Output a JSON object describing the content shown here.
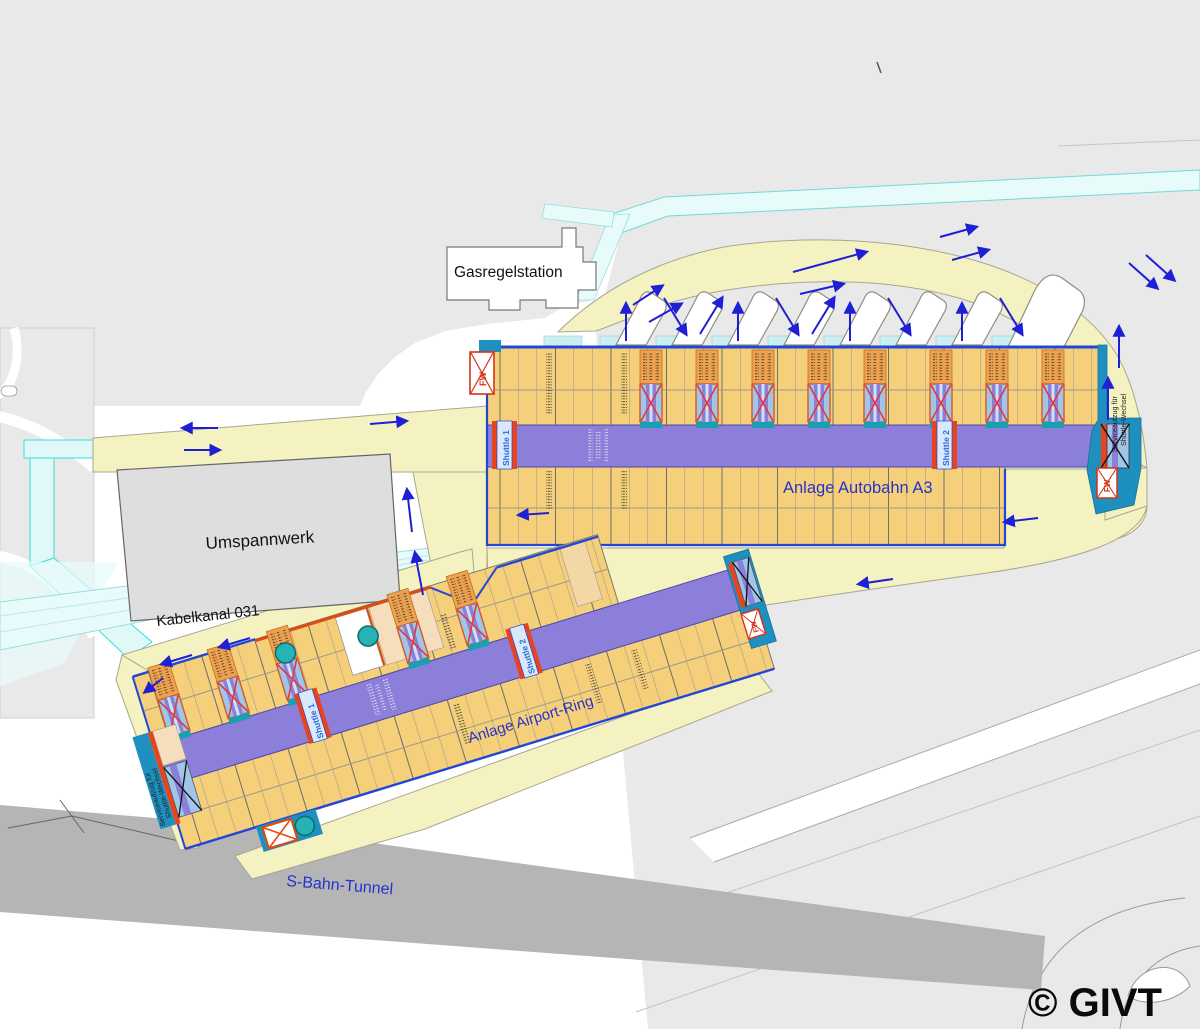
{
  "map": {
    "background_labels": {
      "gasregelstation": "Gasregelstation",
      "umspannwerk": "Umspannwerk",
      "kabelkanal": "Kabelkanal 031",
      "sbahn_tunnel": "S-Bahn-Tunnel"
    },
    "facilities": {
      "autobahn_a3": {
        "label": "Anlage Autobahn A3",
        "shuttle_1": "Shuttle 1",
        "shuttle_2": "Shuttle 2",
        "service_lift_line1": "Serviceaufzug für",
        "service_lift_line2": "Shuttle-Wechsel",
        "fire_dept_label": "FW"
      },
      "airport_ring": {
        "label": "Anlage Airport-Ring",
        "shuttle_1": "Shuttle 1",
        "shuttle_2": "Shuttle 2",
        "service_lift_line1": "Serviceaufzug für",
        "service_lift_line2": "Shuttle-Wechsel",
        "fire_dept_label": "FW"
      }
    },
    "copyright": "© GIVT",
    "colors": {
      "road_yellow": "#f5f2c2",
      "bay_orange": "#f5cf7a",
      "aisle_purple": "#8b7fd9",
      "dock_teal": "#1e90c0",
      "channel_cyan": "#e8fbfb",
      "arrow_blue": "#1f1fd6",
      "label_blue": "#2433cc",
      "alert_red": "#e8431f",
      "tunnel_gray": "#b5b5b5",
      "background_gray": "#e9e9e9"
    }
  }
}
